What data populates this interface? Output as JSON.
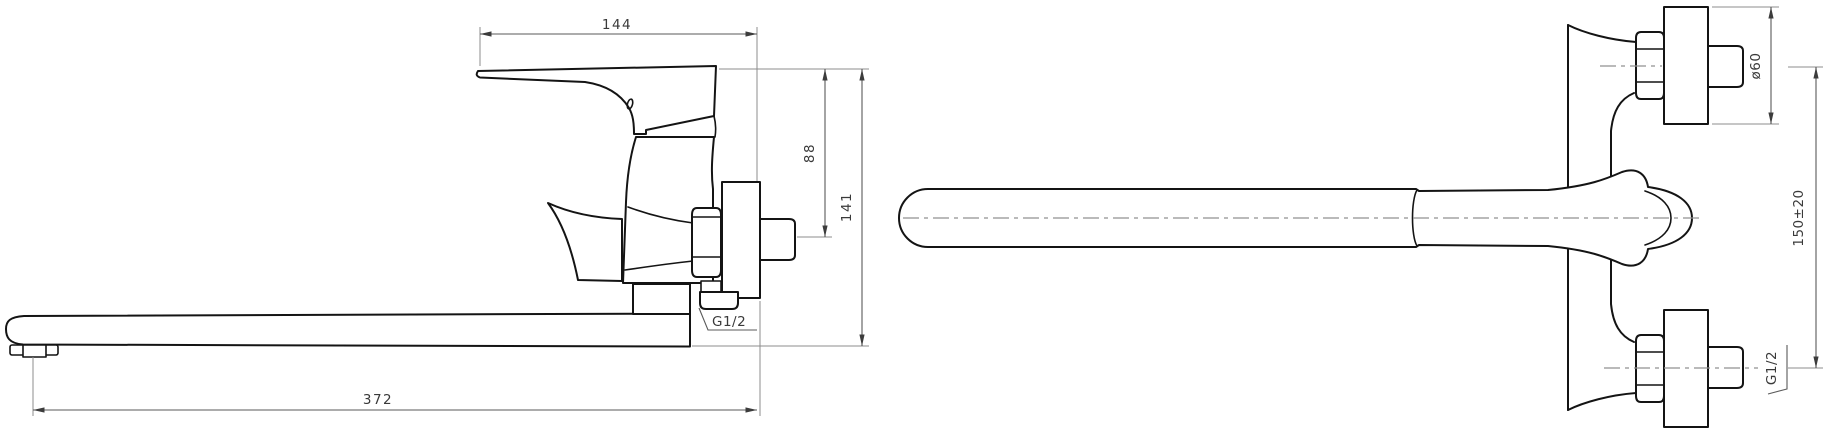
{
  "drawing": {
    "background": "#ffffff",
    "colors": {
      "outline": "#141414",
      "dimension": "#5a5a5a",
      "extension": "#8c8c8c",
      "centerline": "#909090",
      "text": "#3a3a3a",
      "arrow": "#3c3c3c"
    },
    "views": {
      "side": {
        "name": "side-view",
        "dimensions": {
          "handle_reach": {
            "value": "144"
          },
          "top_to_inlet": {
            "value": "88"
          },
          "overall_height": {
            "value": "141"
          },
          "spout_length": {
            "value": "372"
          },
          "outlet_thread": {
            "value": "G1/2"
          }
        }
      },
      "plan": {
        "name": "plan-view",
        "dimensions": {
          "flange_diameter": {
            "value": "ø60"
          },
          "inlet_spacing": {
            "value": "150±20"
          },
          "inlet_thread": {
            "value": "G1/2"
          }
        }
      }
    }
  }
}
